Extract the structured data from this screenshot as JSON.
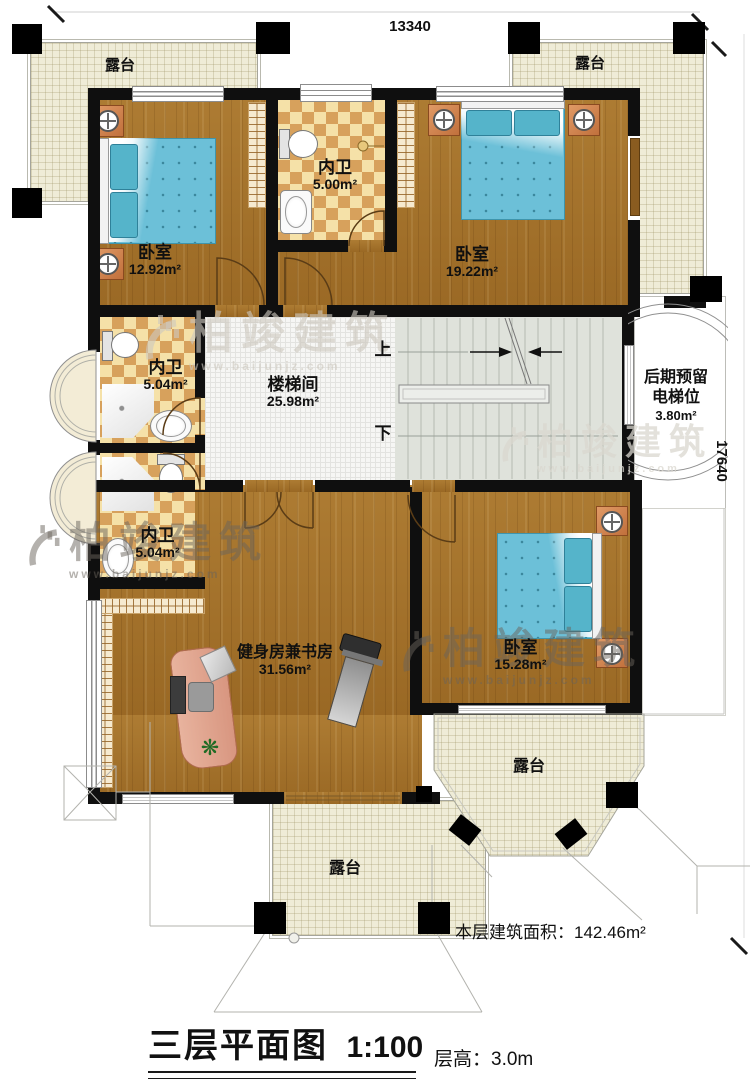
{
  "drawing": {
    "title": "三层平面图",
    "scale": "1:100",
    "floor_height_label": "层高：",
    "floor_height_value": "3.0m",
    "floor_area_label": "本层建筑面积：",
    "floor_area_value": "142.46m²"
  },
  "dimensions": {
    "top_width": "13340",
    "right_height": "17640"
  },
  "rooms": {
    "terrace_top_left": {
      "name": "露台"
    },
    "terrace_top_right": {
      "name": "露台"
    },
    "bedroom_top_left": {
      "name": "卧室",
      "area": "12.92m²"
    },
    "bath_top": {
      "name": "内卫",
      "area": "5.00m²"
    },
    "bedroom_top_right": {
      "name": "卧室",
      "area": "19.22m²"
    },
    "bath_mid_upper": {
      "name": "内卫",
      "area": "5.04m²"
    },
    "bath_mid_lower": {
      "name": "内卫",
      "area": "5.04m²"
    },
    "stairwell": {
      "name": "楼梯间",
      "area": "25.98m²"
    },
    "elevator_reserved": {
      "line1": "后期预留",
      "line2": "电梯位",
      "area": "3.80m²"
    },
    "gym_study": {
      "name": "健身房兼书房",
      "area": "31.56m²"
    },
    "bedroom_bottom": {
      "name": "卧室",
      "area": "15.28m²"
    },
    "terrace_bottom_right": {
      "name": "露台"
    },
    "terrace_bottom_mid": {
      "name": "露台"
    }
  },
  "stairs": {
    "up": "上",
    "down": "下"
  },
  "watermark": {
    "brand": "柏竣建筑",
    "url": "www.baijunjz.com"
  },
  "icons": {
    "plant": "❋"
  },
  "colors": {
    "wall": "#0f0f0f",
    "wood_floor": "#a4722a",
    "tile_dark": "#d7a15c",
    "tile_light": "#f5e1a8",
    "terrace_floor": "#efecd7",
    "bed_blue": "#6cc0d8",
    "stair_floor": "#dfe2db"
  }
}
